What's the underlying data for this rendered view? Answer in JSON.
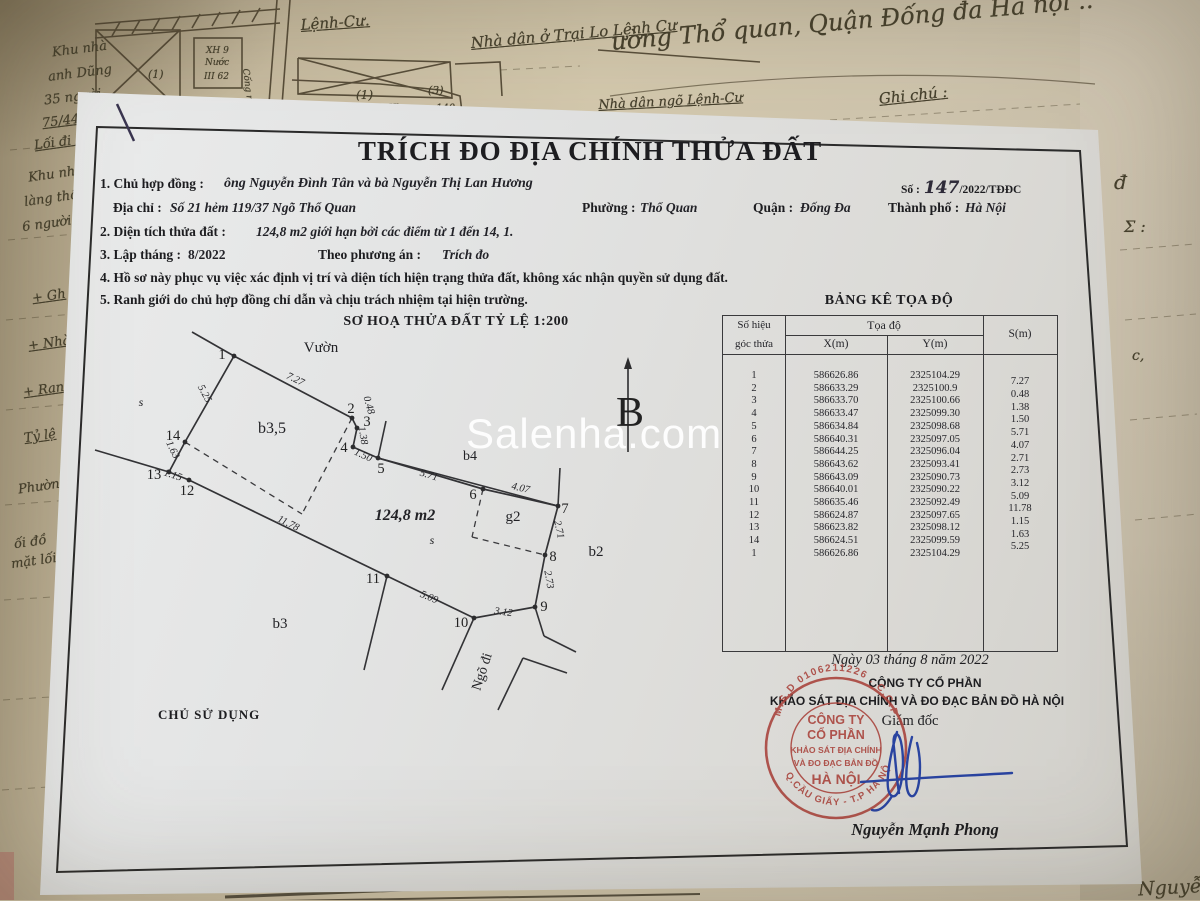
{
  "watermark": {
    "text": "Salenha.com"
  },
  "form": {
    "title": "TRÍCH ĐO ĐỊA CHÍNH THỬA ĐẤT",
    "so": {
      "label": "Số :",
      "number": "147",
      "suffix": "/2022/TĐĐC"
    },
    "line1": {
      "label": "1. Chủ hợp đồng :",
      "value": "ông Nguyễn Đình Tân và bà Nguyễn Thị Lan Hương"
    },
    "line2": {
      "label": "Địa chỉ :",
      "value": "Số 21 hẻm 119/37 Ngõ Thổ Quan",
      "ward_label": "Phường :",
      "ward": "Thổ Quan",
      "district_label": "Quận :",
      "district": "Đống Đa",
      "city_label": "Thành phố :",
      "city": "Hà Nội"
    },
    "line3": {
      "label": "2. Diện tích thửa đất :",
      "value": "124,8 m2 giới hạn bởi các điểm từ 1 đến  14, 1."
    },
    "line4": {
      "label": "3. Lập tháng :",
      "value": "8/2022",
      "plan_label": "Theo phương án :",
      "plan": "Trích đo"
    },
    "line5": "4. Hồ sơ này phục vụ việc xác định vị trí và diện tích hiện trạng thửa đất, không xác nhận quyền sử dụng đất.",
    "line6": "5. Ranh giới do chủ hợp đồng chỉ dẫn và chịu trách nhiệm tại hiện trường.",
    "owner_label": "CHỦ SỬ DỤNG"
  },
  "sketch": {
    "heading": "SƠ HOẠ THỬA ĐẤT TỶ LỆ 1:200",
    "north_label": "B",
    "points": {
      "p1": [
        234,
        356
      ],
      "p2": [
        352,
        418
      ],
      "p3": [
        357,
        428
      ],
      "p4": [
        353,
        447
      ],
      "p5": [
        378,
        458
      ],
      "p6": [
        483,
        489
      ],
      "p7": [
        558,
        506
      ],
      "p8": [
        545,
        555
      ],
      "p9": [
        535,
        607
      ],
      "p10": [
        474,
        618
      ],
      "p11": [
        387,
        576
      ],
      "p12": [
        189,
        480
      ],
      "p13": [
        169,
        472
      ],
      "p14": [
        185,
        442
      ]
    },
    "boundary": [
      "p1",
      "p2",
      "p3",
      "p4",
      "p5",
      "p6",
      "p7",
      "p8",
      "p9",
      "p10",
      "p11",
      "p12",
      "p13",
      "p14",
      "p1"
    ],
    "extra_solid": [
      [
        192,
        332,
        234,
        356
      ],
      [
        95,
        450,
        169,
        472
      ],
      [
        378,
        458,
        558,
        506
      ],
      [
        386,
        421,
        378,
        458
      ],
      [
        560,
        468,
        558,
        506
      ],
      [
        535,
        607,
        544,
        636
      ],
      [
        544,
        636,
        576,
        652
      ],
      [
        474,
        618,
        442,
        690
      ],
      [
        387,
        576,
        364,
        670
      ],
      [
        523,
        658,
        498,
        710
      ],
      [
        523,
        658,
        567,
        673
      ]
    ],
    "dashed": [
      [
        352,
        418,
        302,
        514
      ],
      [
        185,
        442,
        302,
        514
      ],
      [
        483,
        489,
        472,
        537
      ],
      [
        472,
        537,
        545,
        555
      ]
    ],
    "point_labels": [
      [
        "1",
        222,
        354
      ],
      [
        "2",
        351,
        408
      ],
      [
        "3",
        367,
        421
      ],
      [
        "4",
        344,
        447
      ],
      [
        "5",
        381,
        468
      ],
      [
        "6",
        473,
        494
      ],
      [
        "7",
        565,
        508
      ],
      [
        "8",
        553,
        556
      ],
      [
        "9",
        544,
        606
      ],
      [
        "10",
        461,
        622
      ],
      [
        "11",
        373,
        578
      ],
      [
        "12",
        187,
        490
      ],
      [
        "13",
        154,
        474
      ],
      [
        "14",
        173,
        435
      ]
    ],
    "edge_labels": [
      [
        "7.27",
        294,
        382,
        26
      ],
      [
        "0.48",
        366,
        406,
        74
      ],
      [
        "1.38",
        360,
        436,
        80
      ],
      [
        "1.50",
        362,
        458,
        24
      ],
      [
        "5.71",
        428,
        478,
        17
      ],
      [
        "4.07",
        520,
        491,
        13
      ],
      [
        "2.71",
        556,
        530,
        78
      ],
      [
        "2.73",
        546,
        580,
        80
      ],
      [
        "3.12",
        503,
        615,
        8
      ],
      [
        "5.09",
        428,
        600,
        22
      ],
      [
        "11.78",
        287,
        526,
        26
      ],
      [
        "1.15",
        172,
        478,
        18
      ],
      [
        "1.63",
        170,
        451,
        64
      ],
      [
        "5.25",
        202,
        395,
        62
      ]
    ],
    "area_labels": [
      [
        "Vườn",
        321,
        352,
        0,
        15,
        "n"
      ],
      [
        "s",
        141,
        406,
        0,
        12,
        "i"
      ],
      [
        "b3,5",
        272,
        433,
        0,
        16,
        "n"
      ],
      [
        "b4",
        470,
        460,
        0,
        14,
        "n"
      ],
      [
        "124,8 m2",
        405,
        520,
        0,
        16,
        "bi"
      ],
      [
        "s",
        432,
        544,
        0,
        12,
        "i"
      ],
      [
        "g2",
        513,
        521,
        0,
        15,
        "n"
      ],
      [
        "b2",
        596,
        556,
        0,
        15,
        "n"
      ],
      [
        "b3",
        280,
        628,
        0,
        15,
        "n"
      ],
      [
        "Ngõ đi",
        486,
        673,
        -72,
        14,
        "n"
      ]
    ]
  },
  "table": {
    "title": "BẢNG KÊ TỌA ĐỘ",
    "header": {
      "col1a": "Số hiệu",
      "col1b": "góc thửa",
      "group": "Tọa độ",
      "x": "X(m)",
      "y": "Y(m)",
      "s": "S(m)"
    },
    "rows": [
      {
        "id": "1",
        "x": "586626.86",
        "y": "2325104.29"
      },
      {
        "id": "2",
        "x": "586633.29",
        "y": "2325100.9"
      },
      {
        "id": "3",
        "x": "586633.70",
        "y": "2325100.66"
      },
      {
        "id": "4",
        "x": "586633.47",
        "y": "2325099.30"
      },
      {
        "id": "5",
        "x": "586634.84",
        "y": "2325098.68"
      },
      {
        "id": "6",
        "x": "586640.31",
        "y": "2325097.05"
      },
      {
        "id": "7",
        "x": "586644.25",
        "y": "2325096.04"
      },
      {
        "id": "8",
        "x": "586643.62",
        "y": "2325093.41"
      },
      {
        "id": "9",
        "x": "586643.09",
        "y": "2325090.73"
      },
      {
        "id": "10",
        "x": "586640.01",
        "y": "2325090.22"
      },
      {
        "id": "11",
        "x": "586635.46",
        "y": "2325092.49"
      },
      {
        "id": "12",
        "x": "586624.87",
        "y": "2325097.65"
      },
      {
        "id": "13",
        "x": "586623.82",
        "y": "2325098.12"
      },
      {
        "id": "14",
        "x": "586624.51",
        "y": "2325099.59"
      },
      {
        "id": "1",
        "x": "586626.86",
        "y": "2325104.29"
      }
    ],
    "s_values": [
      "7.27",
      "0.48",
      "1.38",
      "1.50",
      "5.71",
      "4.07",
      "2.71",
      "2.73",
      "3.12",
      "5.09",
      "11.78",
      "1.15",
      "1.63",
      "5.25"
    ]
  },
  "footer": {
    "date": "Ngày 03  tháng  8  năm 2022",
    "company_line1": "CÔNG TY CỔ PHẦN",
    "company_line2": "KHẢO SÁT ĐỊA CHÍNH VÀ ĐO ĐẠC BẢN ĐỒ HÀ NỘI",
    "director": "Giám đốc",
    "signer": "Nguyễn Mạnh Phong",
    "stamp": {
      "ring_top": "M.S.D 0106211226 . C.C.P",
      "ring_bottom": "★ Q.CẦU GIẤY - T.P HÀ NỘI",
      "center": [
        "CÔNG TY",
        "CỔ PHẦN",
        "KHẢO SÁT ĐỊA CHÍNH",
        "VÀ ĐO ĐẠC BẢN ĐỒ",
        "HÀ NỘI"
      ],
      "color": "#a8413a"
    },
    "signature_color": "#2a44a0"
  },
  "background": {
    "map_labels": [
      [
        "Lệnh-Cư.",
        300,
        16,
        -4,
        15,
        true
      ],
      [
        "Nhà dân ở Trại Lo Lệnh Cư",
        470,
        34,
        -5,
        15,
        true
      ],
      [
        "Cống ngầm",
        250,
        68,
        83,
        9,
        false
      ],
      [
        "(1)",
        148,
        68,
        0,
        11,
        false
      ],
      [
        "(1)",
        356,
        88,
        0,
        12,
        false
      ],
      [
        "(3)",
        428,
        84,
        0,
        11,
        false
      ],
      [
        "Khu",
        388,
        103,
        0,
        10,
        false
      ],
      [
        "140",
        436,
        103,
        0,
        10,
        false
      ],
      [
        "XH 9",
        206,
        46,
        0,
        9,
        false
      ],
      [
        "Nước",
        205,
        58,
        0,
        9,
        false
      ],
      [
        "III 62",
        204,
        72,
        0,
        9,
        false
      ]
    ],
    "top_left_notes": [
      [
        "Khu nhà",
        52,
        42,
        false
      ],
      [
        "anh Dũng",
        48,
        66,
        false
      ],
      [
        "35 người",
        44,
        90,
        false
      ],
      [
        "75/44",
        42,
        114,
        true
      ]
    ],
    "top_right_notes": [
      [
        "ường Thổ quan, Quận Đống đa Hà nội ..",
        610,
        28,
        -5,
        24,
        false
      ],
      [
        "Ghi chú :",
        878,
        90,
        -6,
        15,
        true
      ],
      [
        "Nhà dân ngõ Lệnh-Cư",
        598,
        98,
        -3,
        13,
        true
      ]
    ],
    "left_notes": [
      [
        "Lối đi ngõ",
        34,
        134,
        true
      ],
      [
        "Khu nhà ở",
        28,
        166,
        false
      ],
      [
        "làng thổ th",
        24,
        190,
        false
      ],
      [
        "6 người 79/",
        22,
        215,
        false
      ],
      [
        "+ Gh",
        32,
        289,
        true
      ],
      [
        "+ Nhà",
        28,
        336,
        true
      ],
      [
        "+ Ranh",
        23,
        382,
        true
      ],
      [
        "Tỷ lệ",
        24,
        429,
        true
      ],
      [
        "Phường",
        18,
        479,
        false
      ],
      [
        "ối đồ",
        14,
        535,
        false
      ],
      [
        "mặt lối",
        11,
        554,
        false
      ]
    ],
    "right_notes": [
      [
        "đ",
        1114,
        170,
        20
      ],
      [
        "Σ :",
        1124,
        217,
        16
      ],
      [
        "c,",
        1132,
        348,
        14
      ]
    ],
    "bottom_note": "Nguyễn C"
  }
}
